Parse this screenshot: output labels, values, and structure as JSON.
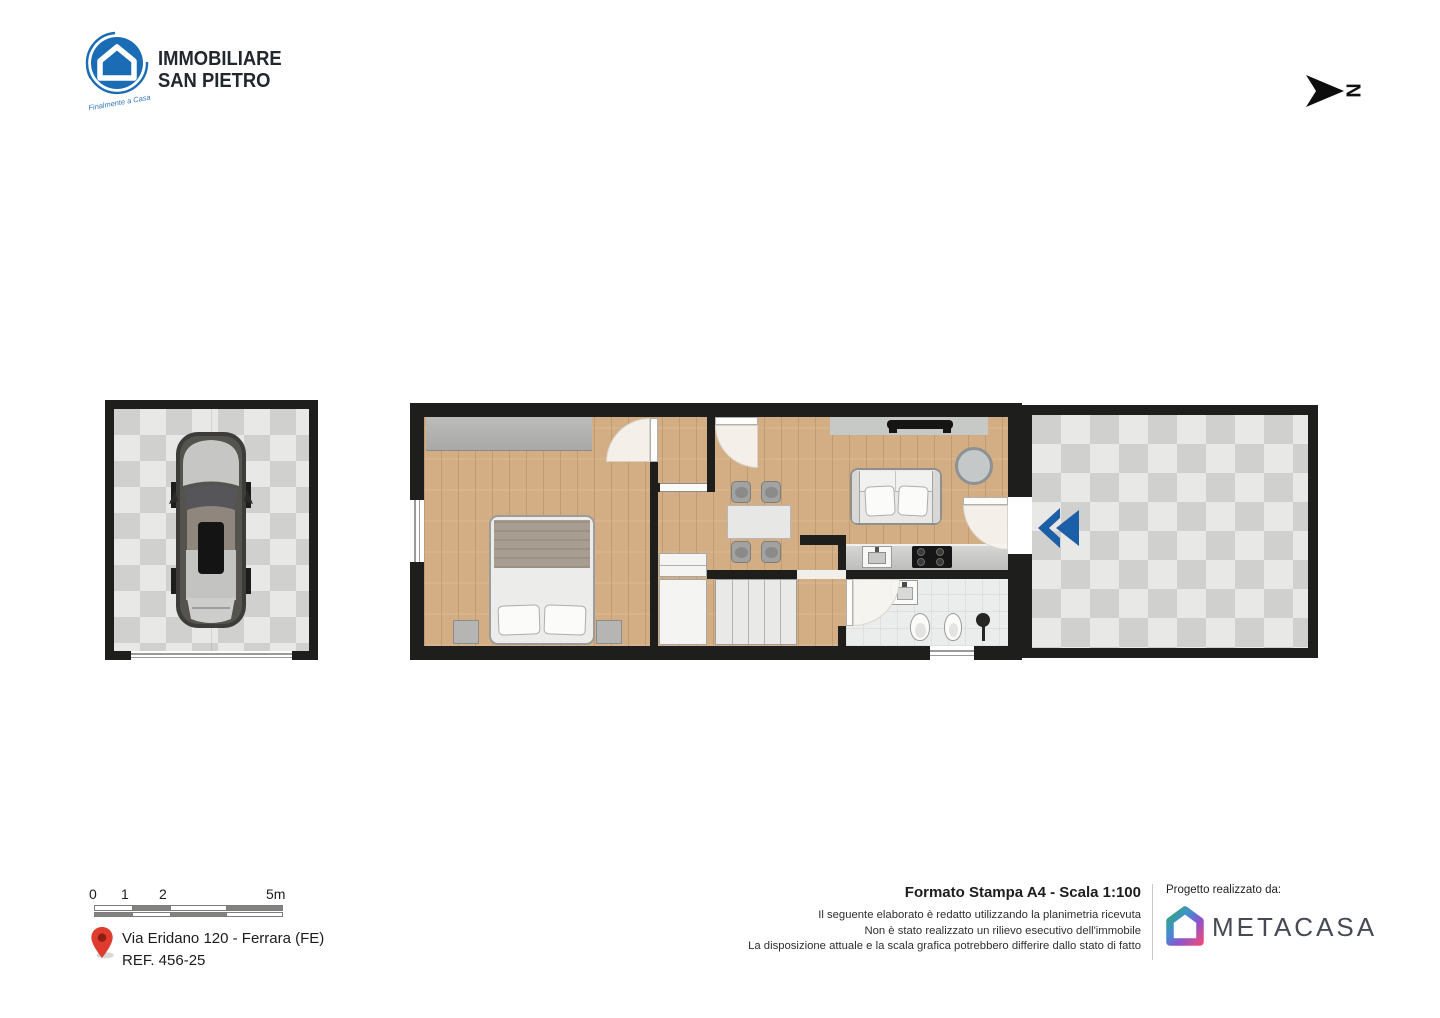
{
  "brand_header": {
    "logo_icon": "house-in-circle-icon",
    "brand_color": "#1a6cb4",
    "name_line1": "IMMOBILIARE",
    "name_line2": "SAN PIETRO",
    "tagline": "Finalmente a Casa"
  },
  "compass": {
    "icon": "north-arrow-icon",
    "label": "N"
  },
  "floorplan": {
    "entrance_arrow_icon": "entrance-double-chevron-icon",
    "entrance_arrow_color": "#1d5fa7",
    "areas": [
      "garage",
      "bedroom",
      "hallway",
      "dining-living",
      "kitchen",
      "bathroom",
      "terrace"
    ]
  },
  "footer": {
    "scale_bar": {
      "labels": [
        "0",
        "1",
        "2",
        "5m"
      ]
    },
    "location": {
      "pin_icon": "map-pin-icon",
      "pin_color": "#e03b2f",
      "address_line1": "Via Eridano 120 - Ferrara (FE)",
      "address_line2": "REF. 456-25"
    },
    "print_info": {
      "title": "Formato Stampa A4 - Scala 1:100",
      "disclaimer_lines": [
        "Il seguente elaborato è redatto utilizzando la planimetria ricevuta",
        "Non è stato realizzato un rilievo esecutivo dell'immobile",
        "La disposizione attuale e la scala grafica potrebbero differire dallo stato di fatto"
      ]
    },
    "credit": {
      "label": "Progetto realizzato da:",
      "icon": "metacasa-house-icon",
      "brand": "METACASA",
      "icon_gradient": [
        "#35a86f",
        "#3f8fd2",
        "#8a54cf",
        "#e34b86"
      ]
    }
  }
}
